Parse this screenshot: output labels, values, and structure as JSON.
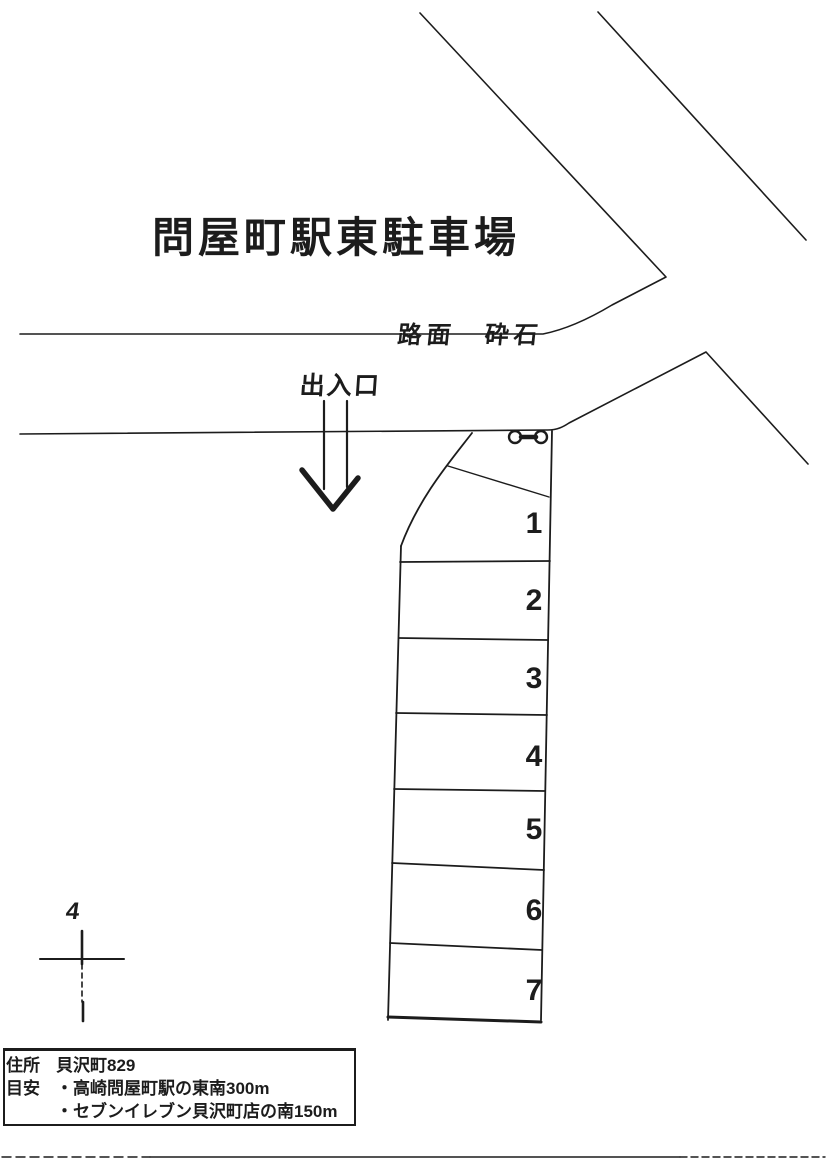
{
  "page": {
    "paper_color": "#ffffff",
    "ink_color": "#1c1c1c"
  },
  "title": "問屋町駅東駐車場",
  "map": {
    "road_surface_label": "路面　砕石",
    "entrance_label": "出入口",
    "north_marker_label": "4",
    "gate_icon": "chain-gate",
    "north_icon": "survey-cross",
    "parking_spaces": [
      "1",
      "2",
      "3",
      "4",
      "5",
      "6",
      "7"
    ]
  },
  "info_box": {
    "address_label": "住所",
    "address_value": "貝沢町829",
    "guide_label": "目安",
    "guide_items": [
      "・高崎問屋町駅の東南300m",
      "・セブンイレブン貝沢町店の南150m"
    ]
  }
}
